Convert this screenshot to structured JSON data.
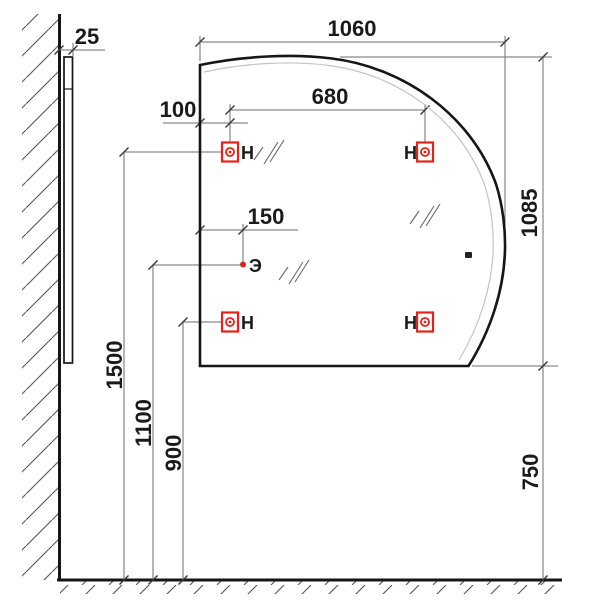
{
  "drawing": {
    "type": "mirror-installation-dimension-drawing",
    "dimensions": {
      "wall_offset": "25",
      "width": "1060",
      "mount_spacing": "680",
      "mount_left_inset": "100",
      "switch_inset": "150",
      "height": "1085",
      "top_mount_height": "1500",
      "switch_height": "1100",
      "bottom_mount_height": "900",
      "bottom_edge_height": "750"
    },
    "labels": {
      "mount": "Н",
      "switch": "Э"
    },
    "colors": {
      "mount_red": "#e3231a",
      "dimension_gray": "#6e6e6e",
      "tick_dark": "#3a3a3a",
      "outline": "#161616",
      "inner_edge": "#c4c4c4",
      "hatch_gray": "#555555"
    }
  }
}
